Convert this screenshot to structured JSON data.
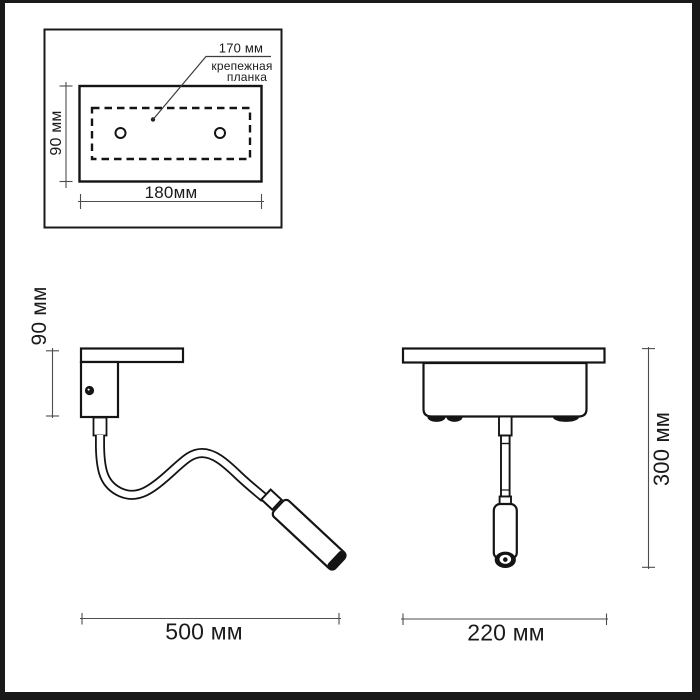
{
  "drawing_type": "lamp-dimension-diagram",
  "colors": {
    "outline": "#141414",
    "dimension_line": "#4d4d4d",
    "background": "#ffffff",
    "frame": "#191919"
  },
  "mounting_plate_inset": {
    "hole_spacing_label": "170 мм",
    "mounting_bar_label_line1": "крепежная",
    "mounting_bar_label_line2": "планка",
    "height_label": "90 мм",
    "width_label": "180мм"
  },
  "side_view": {
    "height_label": "90 мм",
    "width_label": "500 мм"
  },
  "front_view": {
    "height_label": "300 мм",
    "width_label": "220 мм"
  }
}
